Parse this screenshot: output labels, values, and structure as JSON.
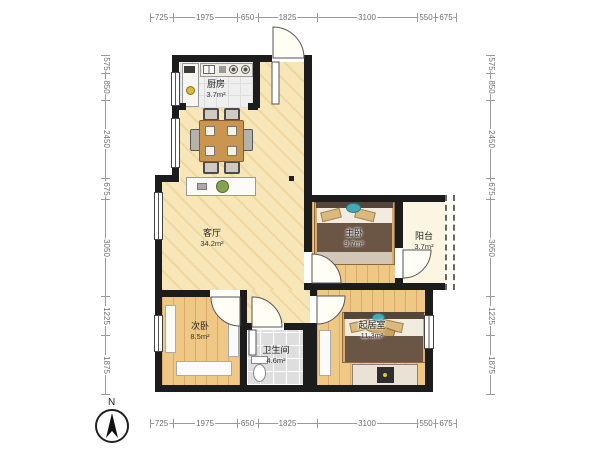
{
  "compass": {
    "north_label": "N"
  },
  "dimensions": {
    "top": [
      "725",
      "1975",
      "650",
      "1825",
      "3100",
      "550",
      "675"
    ],
    "bottom": [
      "725",
      "1975",
      "650",
      "1825",
      "3100",
      "550",
      "675"
    ],
    "left": [
      "575",
      "850",
      "2450",
      "675",
      "3050",
      "1225",
      "1875"
    ],
    "right": [
      "575",
      "850",
      "2450",
      "675",
      "3050",
      "1225",
      "1875"
    ]
  },
  "rooms": {
    "kitchen": {
      "name": "厨房",
      "area": "3.7m²"
    },
    "living": {
      "name": "客厅",
      "area": "34.2m²"
    },
    "master": {
      "name": "主卧",
      "area": "9.7m²"
    },
    "balcony": {
      "name": "阳台",
      "area": "3.7m²"
    },
    "secondary": {
      "name": "次卧",
      "area": "8.5m²"
    },
    "bathroom": {
      "name": "卫生间",
      "area": "4.6m²"
    },
    "sitting": {
      "name": "起居室",
      "area": "11.3m²"
    }
  },
  "colors": {
    "wall": "#1c1c1c",
    "living_floor": "#f7e6b8",
    "wood_floor": "#f0c886",
    "kitchen_floor": "#efefef",
    "bath_floor": "#dedede",
    "balcony_floor": "#faf6e2",
    "dim_line": "#9a9a9a",
    "accent_teal": "#47a8b5"
  }
}
